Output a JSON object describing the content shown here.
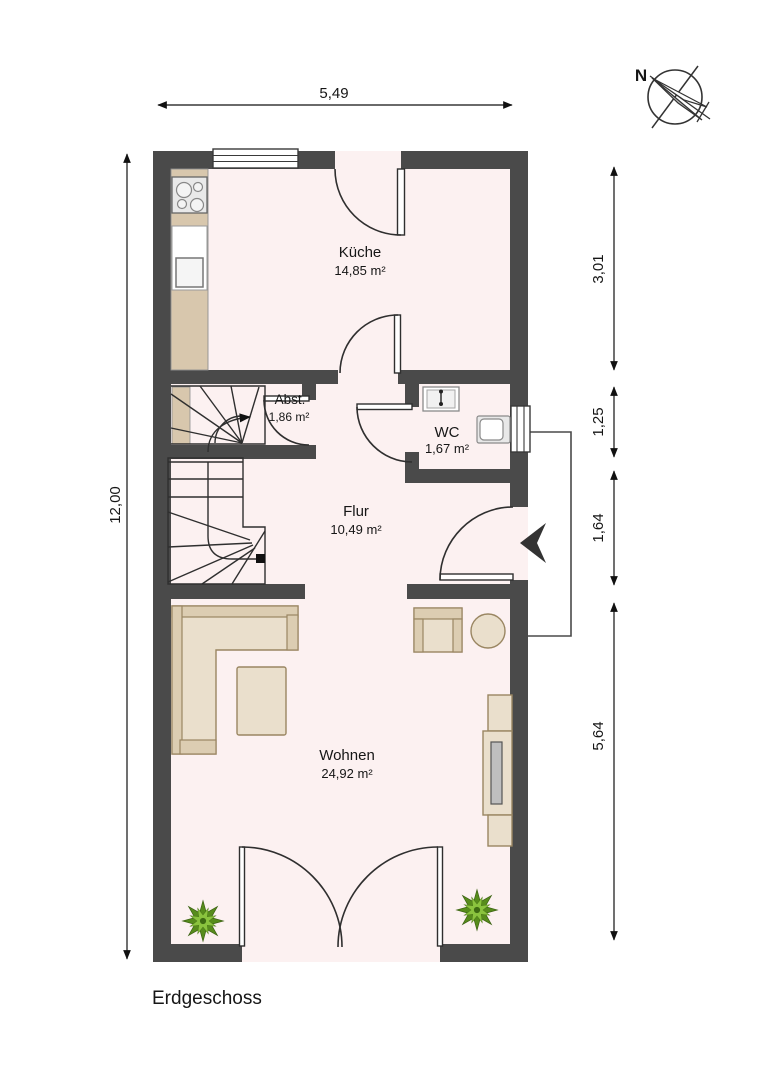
{
  "title": "Erdgeschoss",
  "compass_label": "N",
  "rooms": {
    "kueche": {
      "name": "Küche",
      "area": "14,85 m²"
    },
    "abst": {
      "name": "Abst.",
      "area": "1,86 m²"
    },
    "wc": {
      "name": "WC",
      "area": "1,67 m²"
    },
    "flur": {
      "name": "Flur",
      "area": "10,49 m²"
    },
    "wohnen": {
      "name": "Wohnen",
      "area": "24,92 m²"
    }
  },
  "dimensions": {
    "top": "5,49",
    "left": "12,00",
    "right": [
      "3,01",
      "1,25",
      "1,64",
      "5,64"
    ]
  },
  "colors": {
    "wall": "#4a4a4a",
    "floor": "#fcf1f1",
    "line": "#2f2f2f",
    "furniture": "#eadfcc",
    "furniture_band": "#dccdb2",
    "furniture_border": "#9a8662",
    "counter": "#d8c7ad",
    "fixture_white": "#ffffff",
    "tv_gray": "#bfbfbf",
    "plant_dark": "#578c1c",
    "plant_light": "#8ac33e",
    "dimension": "#111111"
  }
}
